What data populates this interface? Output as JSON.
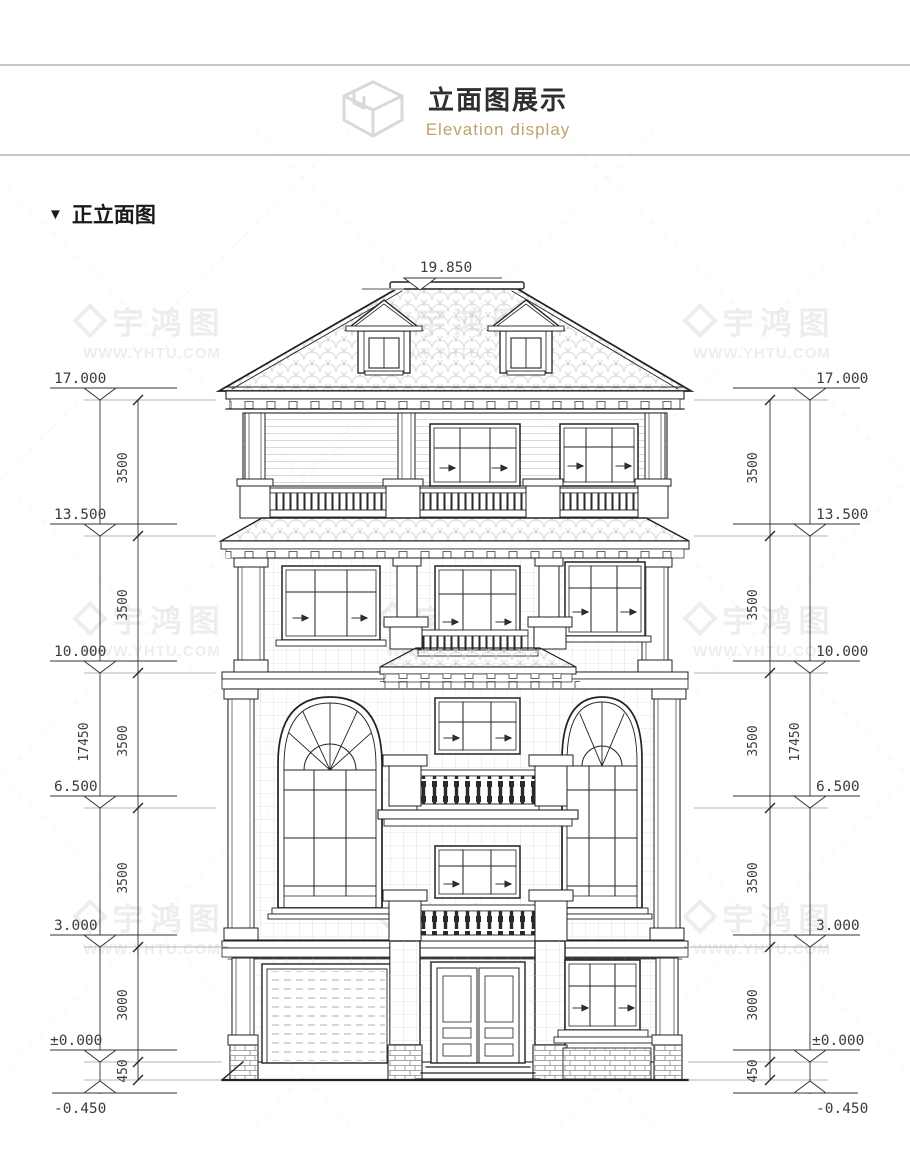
{
  "header": {
    "title": "立面图展示",
    "subtitle": "Elevation display",
    "title_color": "#2e2e2e",
    "subtitle_color": "#bfa36a",
    "divider_color": "#c9c9c9",
    "icon": "isometric-box-icon"
  },
  "section": {
    "marker": "▼",
    "label": "正立面图"
  },
  "watermark": {
    "brand": "宇鸿图",
    "site": "WWW.YHTU.COM",
    "logo": "diamond-logo"
  },
  "drawing": {
    "line_color": "#222222",
    "hatch_color": "#d6d6d6",
    "dimensions": {
      "ridge": "19.850",
      "overall": "17450",
      "levels": [
        "17.000",
        "13.500",
        "10.000",
        "6.500",
        "3.000",
        "±0.000",
        "-0.450"
      ],
      "segments": [
        "3500",
        "3500",
        "3500",
        "3500",
        "3000",
        "450"
      ]
    }
  }
}
